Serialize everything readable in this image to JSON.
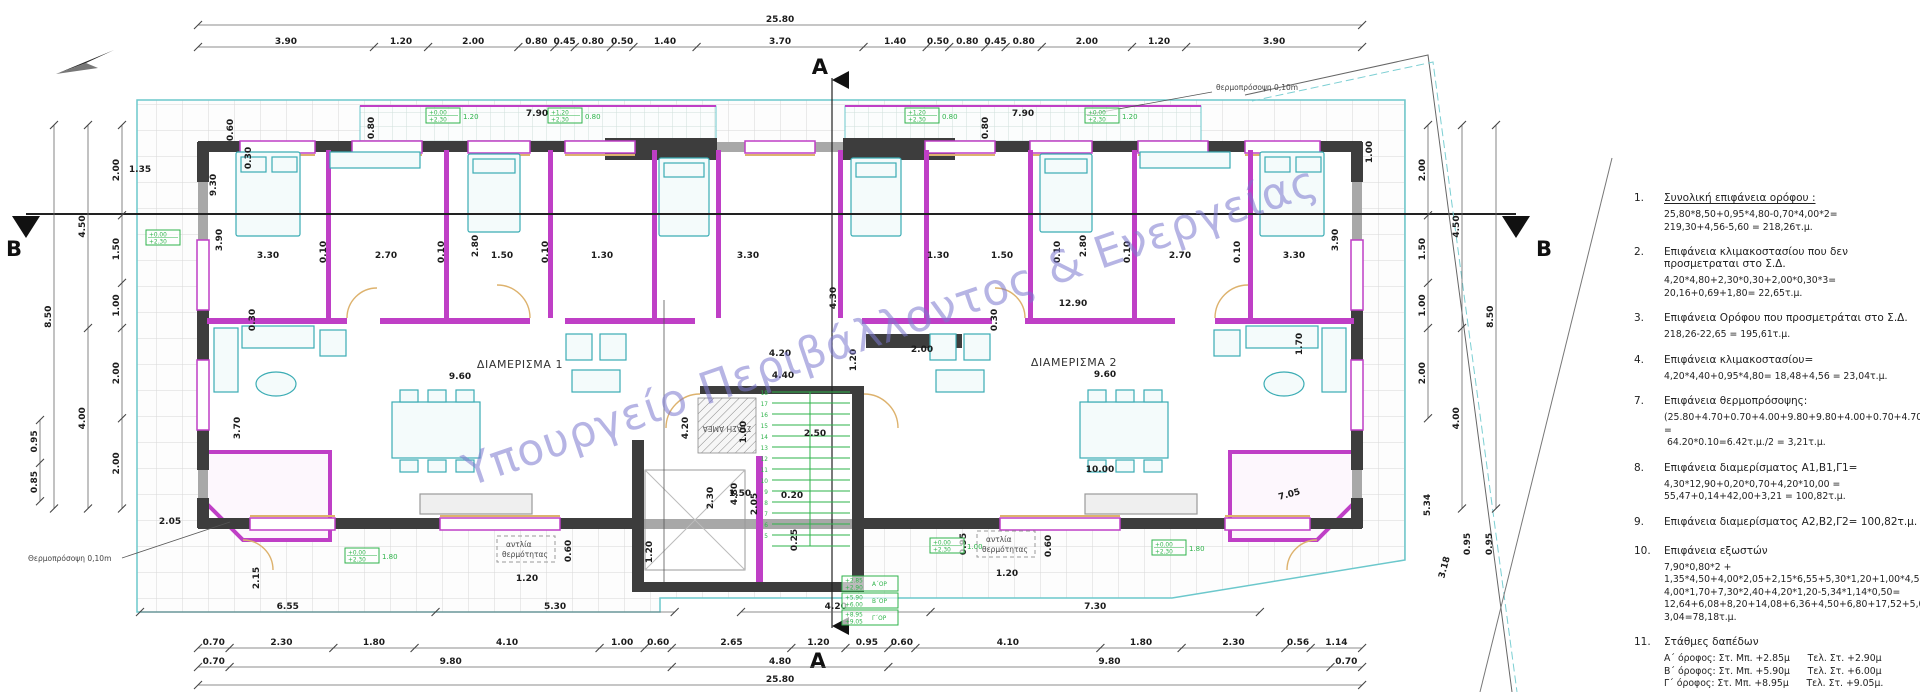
{
  "watermark": "Υπουργείο Περιβάλλοντος & Ενεργείας",
  "labels": {
    "apartment1": "ΔΙΑΜΕΡΙΣΜΑ 1",
    "apartment2": "ΔΙΑΜΕΡΙΣΜΑ 2",
    "ada_stop": "ΣΤΑΣΗ ΑΜΕΑ",
    "thermal_facade_bottom": "Θερμοπρόσοψη 0,10m",
    "thermal_facade_top": "θερμοπρόσοψη 0,10m",
    "heat_pump_line1": "αντλία",
    "heat_pump_line2": "θερμότητας",
    "section_a": "A",
    "section_b": "B"
  },
  "dim_chains": [
    {
      "o": "h",
      "x": 198,
      "y": 25,
      "s": [
        "25.80"
      ]
    },
    {
      "o": "h",
      "x": 198,
      "y": 47,
      "s": [
        "3.90",
        "1.20",
        "2.00",
        "0.80",
        "0.45",
        "0.80",
        "0.50",
        "1.40",
        "3.70",
        "1.40",
        "0.50",
        "0.80",
        "0.45",
        "0.80",
        "2.00",
        "1.20",
        "3.90"
      ]
    },
    {
      "o": "h",
      "x": 140,
      "y": 612,
      "s": [
        "6.55",
        "5.30"
      ]
    },
    {
      "o": "h",
      "x": 741,
      "y": 612,
      "s": [
        "4.20",
        "7.30"
      ]
    },
    {
      "o": "h",
      "x": 198,
      "y": 648,
      "s": [
        "0.70",
        "2.30",
        "1.80",
        "4.10",
        "1.00",
        "0.60",
        "2.65",
        "1.20",
        "0.95",
        "0.60",
        "4.10",
        "1.80",
        "2.30",
        "0.56",
        "1.14"
      ]
    },
    {
      "o": "h",
      "x": 198,
      "y": 667,
      "s": [
        "0.70",
        "9.80",
        "4.80",
        "9.80",
        "0.70"
      ]
    },
    {
      "o": "h",
      "x": 198,
      "y": 685,
      "s": [
        "25.80"
      ]
    },
    {
      "o": "v",
      "x": 122,
      "y": 125,
      "s": [
        "2.00",
        "1.50",
        "1.00",
        "2.00",
        "2.00"
      ]
    },
    {
      "o": "v",
      "x": 88,
      "y": 125,
      "s": [
        "4.50",
        "4.00"
      ]
    },
    {
      "o": "v",
      "x": 54,
      "y": 125,
      "s": [
        "8.50"
      ]
    },
    {
      "o": "v",
      "x": 40,
      "y": 420,
      "s": [
        "0.95",
        "0.85"
      ]
    },
    {
      "o": "v",
      "x": 1428,
      "y": 125,
      "s": [
        "2.00",
        "1.50",
        "1.00",
        "2.00"
      ]
    },
    {
      "o": "v",
      "x": 1462,
      "y": 125,
      "s": [
        "4.50",
        "4.00"
      ]
    },
    {
      "o": "v",
      "x": 1496,
      "y": 125,
      "s": [
        "8.50"
      ]
    }
  ],
  "free_dims": [
    {
      "t": "9.30",
      "x": 216,
      "y": 185,
      "r": -90
    },
    {
      "t": "0.60",
      "x": 233,
      "y": 130,
      "r": -90
    },
    {
      "t": "0.30",
      "x": 251,
      "y": 158,
      "r": -90
    },
    {
      "t": "1.35",
      "x": 140,
      "y": 172,
      "r": 0
    },
    {
      "t": "7.90",
      "x": 537,
      "y": 116,
      "r": 0
    },
    {
      "t": "0.80",
      "x": 374,
      "y": 128,
      "r": -90
    },
    {
      "t": "7.90",
      "x": 1023,
      "y": 116,
      "r": 0
    },
    {
      "t": "0.80",
      "x": 988,
      "y": 128,
      "r": -90
    },
    {
      "t": "1.00",
      "x": 1372,
      "y": 152,
      "r": -90
    },
    {
      "t": "3.90",
      "x": 222,
      "y": 240,
      "r": -90
    },
    {
      "t": "3.30",
      "x": 268,
      "y": 258,
      "r": 0
    },
    {
      "t": "0.10",
      "x": 326,
      "y": 252,
      "r": -90
    },
    {
      "t": "2.70",
      "x": 386,
      "y": 258,
      "r": 0
    },
    {
      "t": "0.10",
      "x": 444,
      "y": 252,
      "r": -90
    },
    {
      "t": "2.80",
      "x": 478,
      "y": 246,
      "r": -90
    },
    {
      "t": "1.50",
      "x": 502,
      "y": 258,
      "r": 0
    },
    {
      "t": "0.10",
      "x": 548,
      "y": 252,
      "r": -90
    },
    {
      "t": "1.30",
      "x": 602,
      "y": 258,
      "r": 0
    },
    {
      "t": "3.30",
      "x": 748,
      "y": 258,
      "r": 0
    },
    {
      "t": "4.30",
      "x": 836,
      "y": 298,
      "r": -90
    },
    {
      "t": "1.30",
      "x": 938,
      "y": 258,
      "r": 0
    },
    {
      "t": "1.50",
      "x": 1002,
      "y": 258,
      "r": 0
    },
    {
      "t": "0.10",
      "x": 1060,
      "y": 252,
      "r": -90
    },
    {
      "t": "2.80",
      "x": 1086,
      "y": 246,
      "r": -90
    },
    {
      "t": "0.10",
      "x": 1130,
      "y": 252,
      "r": -90
    },
    {
      "t": "2.70",
      "x": 1180,
      "y": 258,
      "r": 0
    },
    {
      "t": "0.10",
      "x": 1240,
      "y": 252,
      "r": -90
    },
    {
      "t": "3.30",
      "x": 1294,
      "y": 258,
      "r": 0
    },
    {
      "t": "3.90",
      "x": 1338,
      "y": 240,
      "r": -90
    },
    {
      "t": "0.30",
      "x": 255,
      "y": 320,
      "r": -90
    },
    {
      "t": "0.30",
      "x": 997,
      "y": 320,
      "r": -90
    },
    {
      "t": "12.90",
      "x": 1073,
      "y": 306,
      "r": 0
    },
    {
      "t": "2.00",
      "x": 922,
      "y": 352,
      "r": 0
    },
    {
      "t": "1.20",
      "x": 856,
      "y": 360,
      "r": -90
    },
    {
      "t": "9.60",
      "x": 460,
      "y": 379,
      "r": 0
    },
    {
      "t": "9.60",
      "x": 1105,
      "y": 377,
      "r": 0
    },
    {
      "t": "4.20",
      "x": 780,
      "y": 356,
      "r": 0
    },
    {
      "t": "4.40",
      "x": 783,
      "y": 378,
      "r": 0
    },
    {
      "t": "3.70",
      "x": 240,
      "y": 428,
      "r": -90
    },
    {
      "t": "2.50",
      "x": 815,
      "y": 436,
      "r": 0
    },
    {
      "t": "10.00",
      "x": 1100,
      "y": 472,
      "r": 0
    },
    {
      "t": "1.70",
      "x": 1302,
      "y": 344,
      "r": -90
    },
    {
      "t": "4.20",
      "x": 688,
      "y": 428,
      "r": -90
    },
    {
      "t": "1.00",
      "x": 746,
      "y": 432,
      "r": -90
    },
    {
      "t": "4.80",
      "x": 737,
      "y": 494,
      "r": -90
    },
    {
      "t": "2.05",
      "x": 757,
      "y": 504,
      "r": -90
    },
    {
      "t": "2.30",
      "x": 713,
      "y": 498,
      "r": -90
    },
    {
      "t": "1.50",
      "x": 740,
      "y": 496,
      "r": 0
    },
    {
      "t": "0.20",
      "x": 792,
      "y": 498,
      "r": 0
    },
    {
      "t": "1.20",
      "x": 652,
      "y": 552,
      "r": -90
    },
    {
      "t": "0.25",
      "x": 797,
      "y": 540,
      "r": -90
    },
    {
      "t": "0.95",
      "x": 966,
      "y": 544,
      "r": -90
    },
    {
      "t": "2.05",
      "x": 170,
      "y": 524,
      "r": 0
    },
    {
      "t": "2.15",
      "x": 259,
      "y": 578,
      "r": -90
    },
    {
      "t": "5.34",
      "x": 1430,
      "y": 505,
      "r": -90
    },
    {
      "t": "3.18",
      "x": 1447,
      "y": 568,
      "r": -75
    },
    {
      "t": "0.95",
      "x": 1470,
      "y": 544,
      "r": -90
    },
    {
      "t": "0.95",
      "x": 1492,
      "y": 544,
      "r": -90
    },
    {
      "t": "7.05",
      "x": 1290,
      "y": 497,
      "r": -15
    },
    {
      "t": "1.20",
      "x": 527,
      "y": 581,
      "r": 0
    },
    {
      "t": "0.60",
      "x": 571,
      "y": 551,
      "r": -90
    },
    {
      "t": "1.20",
      "x": 1007,
      "y": 576,
      "r": 0
    },
    {
      "t": "0.60",
      "x": 1051,
      "y": 546,
      "r": -90
    }
  ],
  "green_markers": [
    {
      "x": 426,
      "y": 108,
      "l1": "+0.00",
      "l2": "+2.30",
      "v": "1.20"
    },
    {
      "x": 548,
      "y": 108,
      "l1": "+1.20",
      "l2": "+2.30",
      "v": "0.80"
    },
    {
      "x": 905,
      "y": 108,
      "l1": "+1.20",
      "l2": "+2.30",
      "v": "0.80"
    },
    {
      "x": 1085,
      "y": 108,
      "l1": "+0.00",
      "l2": "+2.30",
      "v": "1.20"
    },
    {
      "x": 146,
      "y": 230,
      "l1": "+0.00",
      "l2": "+2.30",
      "v": ""
    },
    {
      "x": 345,
      "y": 548,
      "l1": "+0.00",
      "l2": "+2.30",
      "v": "1.80"
    },
    {
      "x": 930,
      "y": 538,
      "l1": "+0.00",
      "l2": "+2.30",
      "v": "1.00"
    },
    {
      "x": 1152,
      "y": 540,
      "l1": "+0.00",
      "l2": "+2.30",
      "v": "1.80"
    }
  ],
  "floor_level_markers": [
    {
      "l1": "+2.85",
      "l2": "+2.90",
      "name": "Α΄ΟΡ"
    },
    {
      "l1": "+5.90",
      "l2": "+6.00",
      "name": "Β΄ΟΡ"
    },
    {
      "l1": "+8.95",
      "l2": "+9.05",
      "name": "Γ΄ΟΡ"
    }
  ],
  "stair_numbers": [
    "18",
    "17",
    "16",
    "15",
    "14",
    "13",
    "12",
    "11",
    "10",
    "9",
    "8",
    "7",
    "6",
    "5"
  ],
  "notes": [
    {
      "num": "1.",
      "underline": true,
      "head": "Συνολική επιφάνεια ορόφου :",
      "lines": [
        "25,80*8,50+0,95*4,80-0,70*4,00*2=",
        "219,30+4,56-5,60 = 218,26τ.μ."
      ]
    },
    {
      "num": "2.",
      "head": "Επιφάνεια κλιμακοστασίου που δεν προσμετραται στο Σ.Δ.",
      "lines": [
        "4,20*4,80+2,30*0,30+2,00*0,30*3= 20,16+0,69+1,80= 22,65τ.μ."
      ]
    },
    {
      "num": "3.",
      "head": "Επιφάνεια Ορόφου που προσμετράται στο Σ.Δ.",
      "lines": [
        "218,26-22,65 = 195,61τ.μ."
      ]
    },
    {
      "num": "4.",
      "head": "Επιφάνεια κλιμακοστασίου=",
      "lines": [
        "4,20*4,40+0,95*4,80= 18,48+4,56 = 23,04τ.μ."
      ]
    },
    {
      "num": "7.",
      "head": "Επιφάνεια θερμοπρόσοψης:",
      "lines": [
        "(25.80+4.70+0.70+4.00+9.80+9.80+4.00+0.70+4.70)*0,10 =",
        " 64.20*0.10=6.42τ.μ./2 = 3,21τ.μ."
      ]
    },
    {
      "num": "8.",
      "head": "Επιφάνεια διαμερίσματος Α1,Β1,Γ1=",
      "lines": [
        "4,30*12,90+0,20*0,70+4,20*10,00 = 55,47+0,14+42,00+3,21 = 100,82τ.μ."
      ]
    },
    {
      "num": "9.",
      "head": "Επιφάνεια διαμερίσματος Α2,Β2,Γ2= 100,82τ.μ.",
      "lines": []
    },
    {
      "num": "10.",
      "head": "Επιφάνεια εξωστών",
      "lines": [
        "7,90*0,80*2 + 1,35*4,50+4,00*2,05+2,15*6,55+5,30*1,20+1,00*4,50+",
        "4,00*1,70+7,30*2,40+4,20*1,20-5,34*1,14*0,50=",
        "12,64+6,08+8,20+14,08+6,36+4,50+6,80+17,52+5,04-3,04=78,18τ.μ."
      ]
    },
    {
      "num": "11.",
      "head": "Στάθμες δαπέδων",
      "lines": [
        "Α΄ όροφος: Στ. Μπ. +2.85μ      Τελ. Στ. +2.90μ",
        "Β΄ όροφος: Στ. Μπ. +5.90μ      Τελ. Στ. +6.00μ",
        "Γ΄ όροφος: Στ. Μπ. +8.95μ      Τελ. Στ. +9.05μ."
      ]
    }
  ],
  "colors": {
    "wall_dark": "#3d3d3d",
    "wall_grey": "#a8a8a8",
    "wall_magenta": "#bf3fc6",
    "sill_tan": "#ddb26d",
    "furniture_teal": "#3aacb4",
    "terrace_cyan": "#6cc8cc",
    "marker_green": "#2eb34a",
    "watermark_violet": "#7b78cf"
  }
}
